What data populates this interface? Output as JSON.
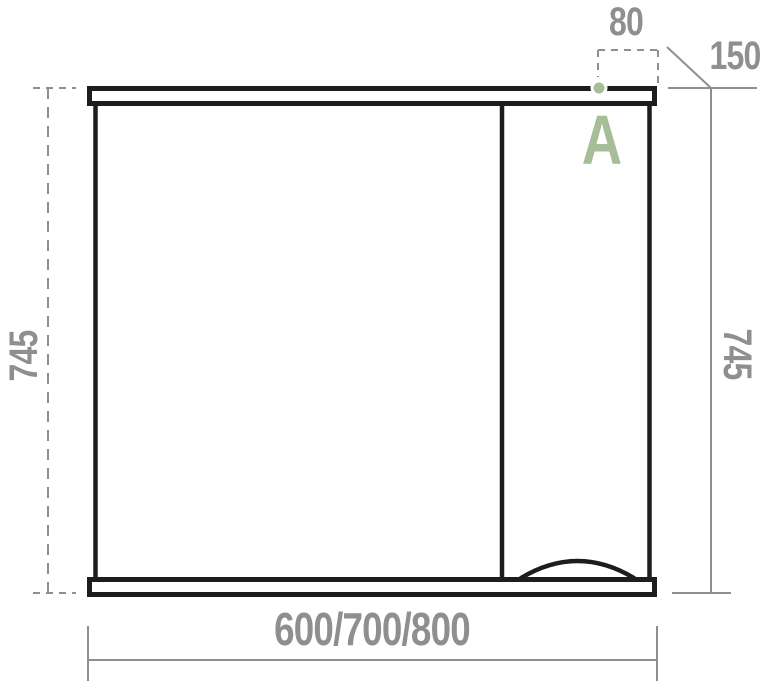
{
  "colors": {
    "outline": "#1d1d1b",
    "dimension": "#8f8f8f",
    "accent": "#a6bd98",
    "background": "#ffffff"
  },
  "dimensions": {
    "top_offset": "80",
    "depth": "150",
    "height_left": "745",
    "height_right": "745",
    "width_options": "600/700/800"
  },
  "marker": {
    "label": "A"
  }
}
